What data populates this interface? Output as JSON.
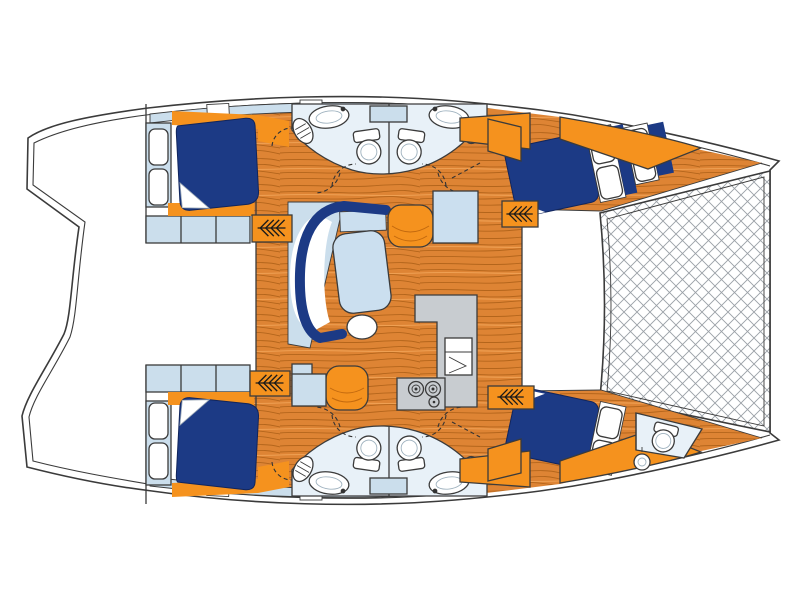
{
  "meta": {
    "title": "Catamaran yacht deck plan (top view) — bridgedeck saloon with galley, four double cabins, four bathrooms, forepeak crew areas and bow trampoline",
    "view": "top-down floor plan",
    "bow_side": "right",
    "stern_side": "left"
  },
  "colors": {
    "navy": "#1C3A85",
    "orange": "#F5921E",
    "wood_base": "#DE8434",
    "wood_grain": "#B4651B",
    "wood_light": "#EFA053",
    "light_blue": "#CBDEEC",
    "bath_floor": "#E8F1F8",
    "table_top": "#CBDFEF",
    "counter_gray": "#C8CCD0",
    "outline_dark": "#3B3B3B",
    "mesh_line": "#9AA0A6"
  },
  "areas": {
    "cockpit": {
      "name": "Aft cockpit and transom steps (outline only)"
    },
    "salon": {
      "name": "Bridgedeck saloon",
      "fixtures": [
        "C-shaped navy settee",
        "coffee table",
        "round stool",
        "ottoman seat (upper)",
        "ottoman seat (lower)",
        "chart seat / side table"
      ]
    },
    "galley": {
      "name": "L-shaped galley",
      "fixtures": [
        "worktop counter",
        "oven / front-opening appliance",
        "stove"
      ],
      "burner_count": 3
    },
    "upper_hull": {
      "name": "Upper hull",
      "aft_cabin": {
        "name": "Aft double cabin",
        "fixtures": [
          "double berth",
          "wardrobe with two doors",
          "storage lockers"
        ]
      },
      "aft_head": {
        "name": "Aft bathroom",
        "fixtures": [
          "washbasin",
          "toilet",
          "porthole"
        ]
      },
      "fwd_head": {
        "name": "Forward bathroom",
        "fixtures": [
          "washbasin",
          "toilet",
          "porthole",
          "skylight window"
        ]
      },
      "fwd_cabin": {
        "name": "Forward double cabin",
        "fixtures": [
          "angled double berth",
          "pillows"
        ]
      },
      "forepeak": {
        "name": "Forepeak berth",
        "fixtures": [
          "berth cushions",
          "pillows"
        ]
      }
    },
    "lower_hull": {
      "name": "Lower hull",
      "aft_cabin": {
        "name": "Aft double cabin",
        "fixtures": [
          "double berth",
          "wardrobe with two doors",
          "storage lockers"
        ]
      },
      "aft_head": {
        "name": "Aft bathroom",
        "fixtures": [
          "washbasin",
          "toilet",
          "porthole"
        ]
      },
      "fwd_head": {
        "name": "Forward bathroom",
        "fixtures": [
          "washbasin",
          "toilet",
          "porthole",
          "skylight window"
        ]
      },
      "fwd_cabin": {
        "name": "Forward double cabin",
        "fixtures": [
          "angled double berth",
          "pillows"
        ]
      },
      "forepeak": {
        "name": "Forepeak crew area",
        "fixtures": [
          "berth",
          "toilet",
          "washbasin"
        ]
      }
    },
    "trampoline": {
      "name": "Bow trampoline net"
    },
    "companionways": {
      "name": "Companionway steps between saloon and hulls",
      "count": 4
    },
    "doors": {
      "name": "Door swing arcs (dashed)"
    }
  },
  "icons": {
    "steps": "companionway-steps-icon",
    "door_swing": "door-swing-arc-icon",
    "porthole": "porthole-icon",
    "sink": "washbasin-icon",
    "toilet": "toilet-icon",
    "stove": "stove-burners-icon"
  }
}
